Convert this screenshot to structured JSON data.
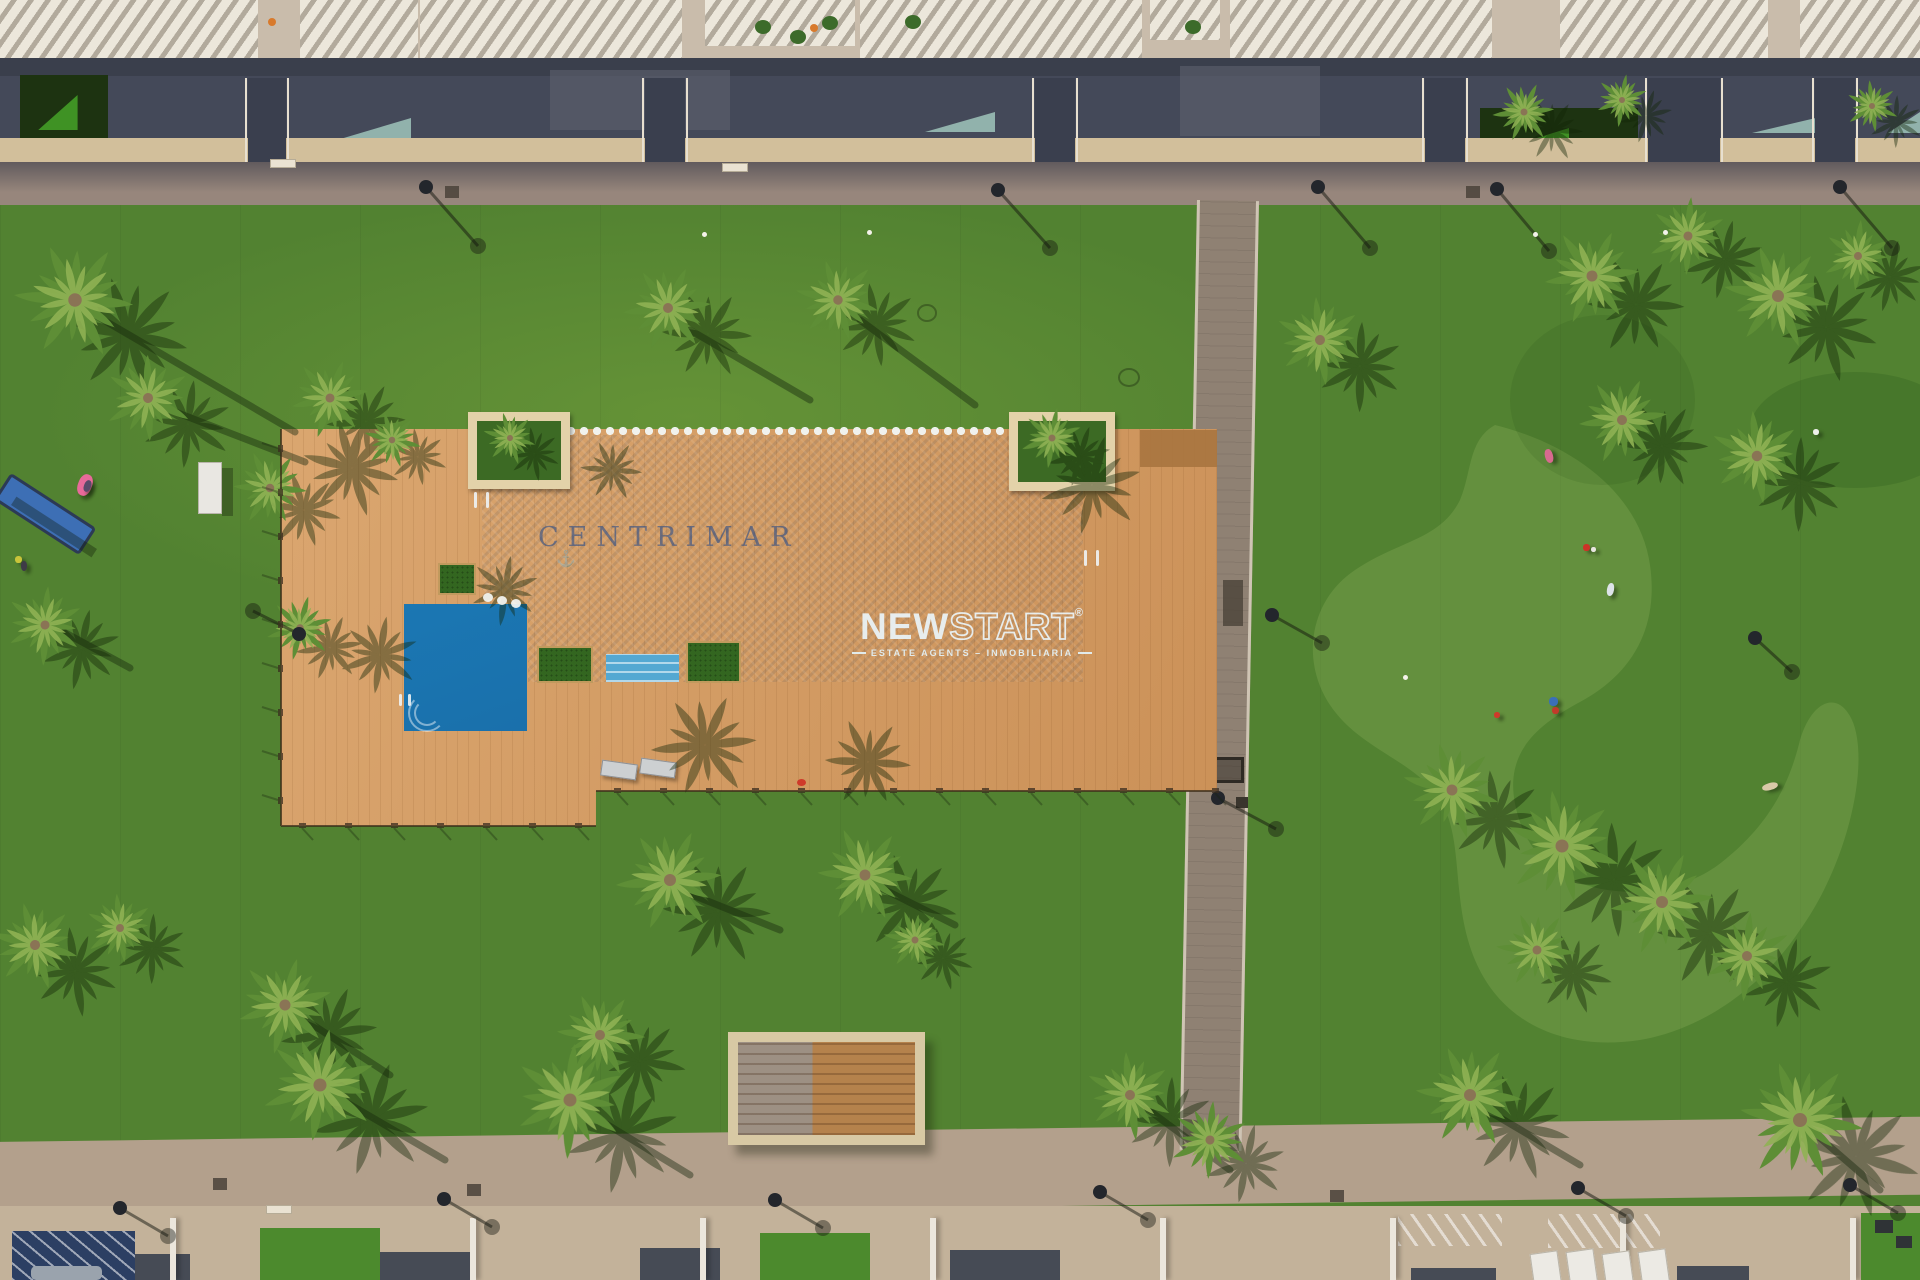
{
  "watermarks": {
    "pool_name": "CENTRIMAR",
    "anchor_icon": "⚓",
    "brand": {
      "bold": "NEW",
      "outline": "START",
      "registered": "®",
      "tagline": "ESTATE AGENTS – INMOBILIARIA"
    }
  },
  "colors": {
    "lawn": "#528231",
    "lawn_light": "#8fb45c",
    "pool_blue": "#1a78b4",
    "pool_steps": "#54a8d2",
    "deck_wood": "#d49a60",
    "planter_stone": "#e3d2a9",
    "path_gray": "#8f8173",
    "promenade_top": "#97867c",
    "promenade_bottom": "#b3a08c",
    "building_shadow": "#444959",
    "wall_beige": "#d2bf9b",
    "palm_green": "#5e8e36",
    "palm_green_light": "#8fb254",
    "palm_shadow": "#132608",
    "pergola_navy": "#2c3f63",
    "logo_white": "#eaf4f8",
    "watermark_blue": "rgba(25,68,138,0.55)"
  },
  "scene": {
    "palms": [
      [
        75,
        300,
        1.35,
        10
      ],
      [
        148,
        398,
        1.0,
        -25
      ],
      [
        45,
        625,
        0.9,
        40
      ],
      [
        270,
        488,
        0.85,
        70
      ],
      [
        300,
        628,
        0.75,
        -10
      ],
      [
        330,
        398,
        0.9,
        55
      ],
      [
        392,
        440,
        0.65,
        -40
      ],
      [
        510,
        438,
        0.6,
        20
      ],
      [
        1052,
        438,
        0.7,
        -15
      ],
      [
        668,
        308,
        1.0,
        0
      ],
      [
        838,
        300,
        0.95,
        140
      ],
      [
        1320,
        340,
        1.0,
        30
      ],
      [
        1524,
        112,
        0.7,
        0
      ],
      [
        1622,
        100,
        0.6,
        45
      ],
      [
        1872,
        106,
        0.6,
        -30
      ],
      [
        1592,
        276,
        1.1,
        60
      ],
      [
        1688,
        236,
        0.9,
        -20
      ],
      [
        1778,
        296,
        1.2,
        15
      ],
      [
        1858,
        256,
        0.8,
        100
      ],
      [
        1622,
        420,
        1.0,
        -60
      ],
      [
        1757,
        456,
        1.05,
        30
      ],
      [
        1452,
        790,
        1.1,
        20
      ],
      [
        1562,
        846,
        1.3,
        -35
      ],
      [
        1662,
        902,
        1.2,
        60
      ],
      [
        1537,
        950,
        0.9,
        10
      ],
      [
        1747,
        956,
        1.0,
        -80
      ],
      [
        35,
        945,
        1.0,
        20
      ],
      [
        120,
        928,
        0.8,
        -30
      ],
      [
        285,
        1005,
        1.1,
        50
      ],
      [
        320,
        1085,
        1.3,
        -15
      ],
      [
        570,
        1100,
        1.3,
        40
      ],
      [
        670,
        880,
        1.2,
        0
      ],
      [
        865,
        875,
        1.1,
        70
      ],
      [
        600,
        1035,
        1.0,
        -50
      ],
      [
        915,
        940,
        0.7,
        15
      ],
      [
        1130,
        1095,
        1.0,
        30
      ],
      [
        1210,
        1140,
        0.9,
        -20
      ],
      [
        1470,
        1095,
        1.2,
        10
      ],
      [
        1800,
        1120,
        1.4,
        -45
      ]
    ],
    "deck_shadows": [
      [
        352,
        468,
        1.1,
        20
      ],
      [
        380,
        655,
        0.9,
        -15
      ],
      [
        705,
        745,
        1.2,
        0
      ],
      [
        868,
        762,
        1.0,
        70
      ],
      [
        1092,
        485,
        1.15,
        -10
      ],
      [
        505,
        590,
        0.8,
        45
      ],
      [
        612,
        470,
        0.7,
        10
      ]
    ],
    "shadow_lines": [
      [
        95,
        315,
        295,
        432
      ],
      [
        165,
        408,
        305,
        462
      ],
      [
        60,
        630,
        130,
        668
      ],
      [
        690,
        330,
        810,
        400
      ],
      [
        860,
        320,
        975,
        405
      ],
      [
        680,
        890,
        780,
        930
      ],
      [
        875,
        885,
        955,
        925
      ],
      [
        1470,
        1100,
        1580,
        1165
      ],
      [
        1805,
        1125,
        1880,
        1190
      ],
      [
        290,
        1010,
        390,
        1075
      ],
      [
        325,
        1090,
        445,
        1160
      ],
      [
        575,
        1105,
        690,
        1175
      ],
      [
        1135,
        1100,
        1230,
        1170
      ]
    ],
    "lamps": [
      [
        426,
        187,
        478,
        246
      ],
      [
        998,
        190,
        1050,
        248
      ],
      [
        1318,
        187,
        1370,
        248
      ],
      [
        1497,
        189,
        1549,
        251
      ],
      [
        1840,
        187,
        1892,
        248
      ],
      [
        299,
        634,
        253,
        611
      ],
      [
        1272,
        615,
        1322,
        643
      ],
      [
        1218,
        798,
        1276,
        829
      ],
      [
        1755,
        638,
        1792,
        672
      ],
      [
        120,
        1208,
        168,
        1236
      ],
      [
        444,
        1199,
        492,
        1227
      ],
      [
        775,
        1200,
        823,
        1228
      ],
      [
        1100,
        1192,
        1148,
        1220
      ],
      [
        1578,
        1188,
        1626,
        1216
      ],
      [
        1850,
        1185,
        1898,
        1213
      ]
    ],
    "people": [
      {
        "x": 78,
        "y": 474,
        "w": 14,
        "h": 22,
        "c": "#e86a9a",
        "r": 20
      },
      {
        "x": 84,
        "y": 480,
        "w": 7,
        "h": 12,
        "c": "#5a4a6a",
        "r": 20
      },
      {
        "x": 15,
        "y": 556,
        "w": 7,
        "h": 7,
        "c": "#c8c43a",
        "r": 0
      },
      {
        "x": 21,
        "y": 561,
        "w": 6,
        "h": 10,
        "c": "#3e3a46",
        "r": 0
      },
      {
        "x": 1545,
        "y": 449,
        "w": 8,
        "h": 14,
        "c": "#d86a8f",
        "r": -15
      },
      {
        "x": 1583,
        "y": 544,
        "w": 7,
        "h": 7,
        "c": "#cc3327",
        "r": 0
      },
      {
        "x": 1591,
        "y": 547,
        "w": 5,
        "h": 5,
        "c": "#e8e6e0",
        "r": 0
      },
      {
        "x": 1607,
        "y": 583,
        "w": 7,
        "h": 13,
        "c": "#dde3e8",
        "r": 10
      },
      {
        "x": 1549,
        "y": 697,
        "w": 9,
        "h": 9,
        "c": "#3a6fb8",
        "r": 0
      },
      {
        "x": 1552,
        "y": 707,
        "w": 7,
        "h": 7,
        "c": "#c23b2a",
        "r": 0
      },
      {
        "x": 1762,
        "y": 783,
        "w": 16,
        "h": 7,
        "c": "#d9c9a8",
        "r": -15
      },
      {
        "x": 1813,
        "y": 429,
        "w": 6,
        "h": 6,
        "c": "#eef0ea",
        "r": 0
      },
      {
        "x": 1494,
        "y": 712,
        "w": 6,
        "h": 6,
        "c": "#cf3a2a",
        "r": 0
      }
    ],
    "drains": [
      [
        445,
        186
      ],
      [
        1466,
        186
      ],
      [
        213,
        1178
      ],
      [
        467,
        1184
      ],
      [
        1330,
        1190
      ]
    ],
    "plaques": [
      [
        270,
        159
      ],
      [
        722,
        163
      ],
      [
        266,
        1205
      ]
    ],
    "sprinklers": [
      [
        1533,
        232
      ],
      [
        1663,
        230
      ],
      [
        1403,
        675
      ],
      [
        702,
        232
      ],
      [
        867,
        230
      ]
    ],
    "manholes": [
      [
        1118,
        368,
        18
      ],
      [
        917,
        304,
        16
      ]
    ],
    "pool_dots": [
      [
        483,
        593
      ],
      [
        497,
        596
      ],
      [
        511,
        599
      ]
    ],
    "fences": [
      {
        "x": 281,
        "y1": 429,
        "y2": 826,
        "vertical": true
      },
      {
        "y": 826,
        "x1": 281,
        "x2": 596,
        "vertical": false
      },
      {
        "y": 791,
        "x1": 596,
        "x2": 1217,
        "vertical": false
      }
    ],
    "roof_slabs": [
      [
        0,
        0,
        258,
        112
      ],
      [
        300,
        0,
        118,
        66
      ],
      [
        420,
        0,
        262,
        92
      ],
      [
        705,
        0,
        150,
        46
      ],
      [
        860,
        0,
        282,
        78
      ],
      [
        1150,
        0,
        70,
        40
      ],
      [
        1230,
        0,
        262,
        64
      ],
      [
        1560,
        0,
        208,
        86
      ],
      [
        1800,
        0,
        120,
        62
      ]
    ],
    "band_lights": [
      [
        550,
        70,
        180,
        60
      ],
      [
        1180,
        66,
        140,
        70
      ]
    ],
    "hedges": [
      [
        20,
        75,
        88,
        64
      ],
      [
        1480,
        108,
        158,
        40
      ]
    ],
    "glass_tris": [
      [
        337,
        118,
        74,
        22
      ],
      [
        925,
        112,
        70,
        20
      ],
      [
        1752,
        113,
        85,
        20
      ],
      [
        1888,
        112,
        32,
        21
      ]
    ],
    "gates": [
      [
        248,
        38
      ],
      [
        645,
        40
      ],
      [
        1035,
        40
      ],
      [
        1425,
        40
      ],
      [
        1648,
        72
      ],
      [
        1815,
        40
      ]
    ],
    "terrace_plants": [
      [
        755,
        20
      ],
      [
        790,
        30
      ],
      [
        822,
        16
      ],
      [
        1185,
        20
      ],
      [
        905,
        15
      ]
    ],
    "terrace_flowers": [
      [
        810,
        24
      ],
      [
        268,
        18
      ]
    ],
    "hatches": [
      [
        1398,
        1214,
        104,
        32
      ],
      [
        1548,
        1214,
        112,
        34
      ]
    ],
    "roofblocks": [
      [
        120,
        1254,
        70,
        26
      ],
      [
        380,
        1252,
        90,
        28
      ],
      [
        640,
        1248,
        80,
        32
      ],
      [
        950,
        1250,
        110,
        30
      ],
      [
        1411,
        1268,
        85,
        12
      ],
      [
        1677,
        1266,
        72,
        14
      ]
    ],
    "walls_v": [
      170,
      470,
      700,
      930,
      1160,
      1390,
      1620,
      1850
    ],
    "green_patches": [
      [
        260,
        1228,
        120,
        52
      ],
      [
        760,
        1233,
        110,
        47
      ],
      [
        1861,
        1213,
        59,
        67
      ]
    ],
    "dark_chairs": [
      [
        1875,
        1220,
        18,
        13
      ],
      [
        1896,
        1236,
        16,
        12
      ]
    ],
    "white_loungers": [
      [
        1532,
        1252
      ],
      [
        1568,
        1250
      ],
      [
        1604,
        1252
      ],
      [
        1640,
        1250
      ]
    ],
    "turf_blobs": [
      {
        "x": 1750,
        "y": 372,
        "w": 210,
        "h": 116,
        "c": "rgba(20,60,10,0.16)"
      },
      {
        "x": 1510,
        "y": 315,
        "w": 185,
        "h": 170,
        "c": "rgba(20,60,10,0.10)"
      }
    ]
  }
}
